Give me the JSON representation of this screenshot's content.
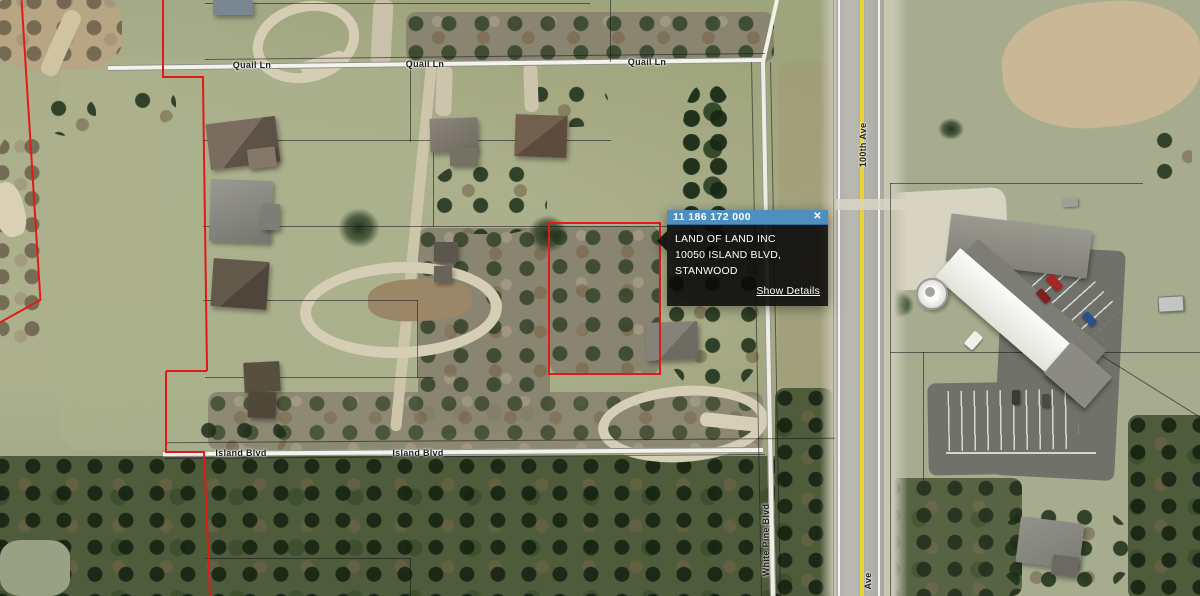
{
  "popup": {
    "parcel_id": "11 186 172 000",
    "owner": "LAND OF LAND INC",
    "address": "10050 ISLAND BLVD, STANWOOD",
    "details_link": "Show Details",
    "close_label": "✕"
  },
  "map": {
    "labels": {
      "quail_ln_1": "Quail Ln",
      "quail_ln_2": "Quail Ln",
      "quail_ln_3": "Quail Ln",
      "hundredth_ave": "100th Ave",
      "hundredth_ave_bottom": "Ave",
      "island_blvd_1": "Island Blvd",
      "island_blvd_2": "Island Blvd",
      "white_pine_blvd": "White Pine Blvd"
    },
    "colors": {
      "selection_red": "#e01b17",
      "road_centerline_yellow": "#e9d234",
      "popup_header_blue": "#4e8fc0",
      "popup_body_black": "rgba(10,10,10,0.84)"
    }
  }
}
